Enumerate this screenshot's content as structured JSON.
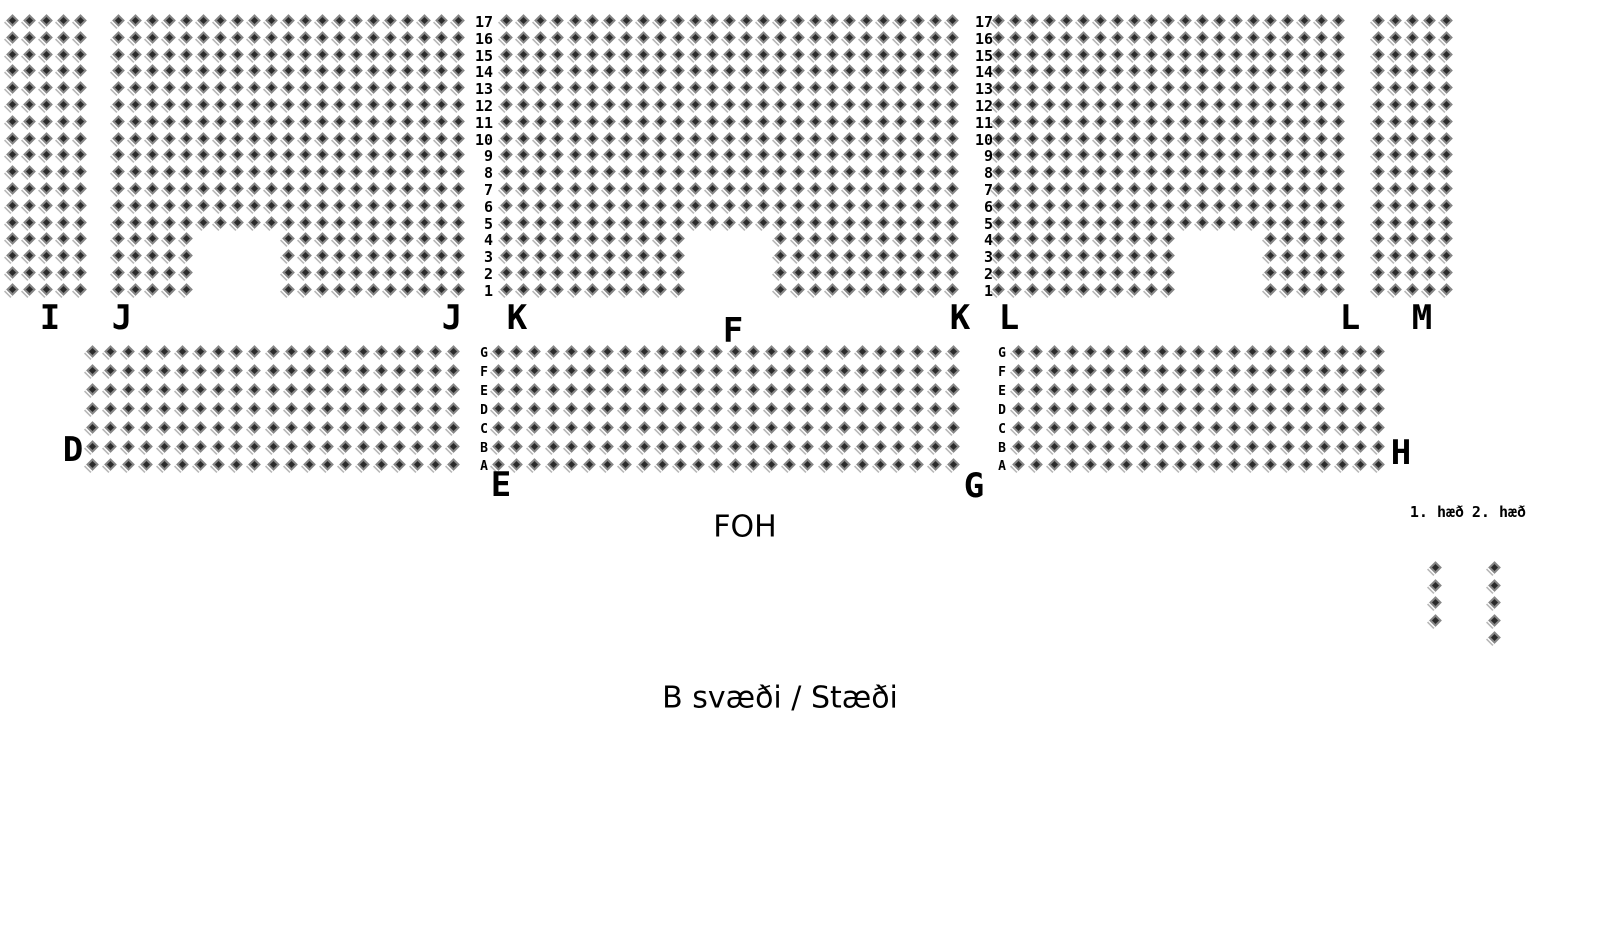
{
  "canvas": {
    "width": 1610,
    "height": 950,
    "background": "#ffffff"
  },
  "labels": {
    "foh": "FOH",
    "area_title": "B svæði / Stæði",
    "legend_floor1": "1. hæð",
    "legend_floor2": "2. hæð"
  },
  "seat_style": {
    "body_color": "#868686",
    "shadow_color": "#b6b6b6",
    "highlight_color": "#ffffff",
    "center_color": "#2a2a2a"
  },
  "seatmap": {
    "row_numbers": [
      "17",
      "16",
      "15",
      "14",
      "13",
      "12",
      "11",
      "10",
      "9",
      "8",
      "7",
      "6",
      "5",
      "4",
      "3",
      "2",
      "1"
    ],
    "row_letters": [
      "G",
      "F",
      "E",
      "D",
      "C",
      "B",
      "A"
    ],
    "sections": [
      {
        "id": "I",
        "x": 6,
        "y": 14,
        "cols": 5,
        "rows": 17,
        "pitch_x": 17.0,
        "pitch_y": 16.8
      },
      {
        "id": "J",
        "x": 112,
        "y": 14,
        "cols": 21,
        "rows": 17,
        "pitch_x": 17.0,
        "pitch_y": 16.8,
        "notch": {
          "col_start": 6,
          "col_end": 10,
          "bottom_rows": 4
        }
      },
      {
        "id": "K",
        "x": 500,
        "y": 14,
        "cols": 27,
        "rows": 17,
        "pitch_x": 17.15,
        "pitch_y": 16.8,
        "notch": {
          "col_start": 12,
          "col_end": 16,
          "bottom_rows": 4
        }
      },
      {
        "id": "L",
        "x": 992,
        "y": 14,
        "cols": 21,
        "rows": 17,
        "pitch_x": 17.0,
        "pitch_y": 16.8,
        "notch": {
          "col_start": 12,
          "col_end": 16,
          "bottom_rows": 4
        }
      },
      {
        "id": "M",
        "x": 1372,
        "y": 14,
        "cols": 5,
        "rows": 17,
        "pitch_x": 17.0,
        "pitch_y": 16.8
      },
      {
        "id": "D",
        "x": 86,
        "y": 345,
        "cols": 21,
        "rows": 7,
        "pitch_x": 18.05,
        "pitch_y": 18.9
      },
      {
        "id": "E",
        "x": 492,
        "y": 345,
        "cols": 26,
        "rows": 7,
        "pitch_x": 18.2,
        "pitch_y": 18.9
      },
      {
        "id": "G",
        "x": 1012,
        "y": 345,
        "cols": 21,
        "rows": 7,
        "pitch_x": 18.0,
        "pitch_y": 18.9
      },
      {
        "id": "floor1-legend",
        "x": 1429,
        "y": 561,
        "cols": 1,
        "rows": 4,
        "pitch_x": 17.5,
        "pitch_y": 17.5
      },
      {
        "id": "floor2-legend",
        "x": 1488,
        "y": 561,
        "cols": 1,
        "rows": 5,
        "pitch_x": 17.5,
        "pitch_y": 17.5
      }
    ],
    "number_columns": [
      {
        "x": 461,
        "y": 14,
        "width": 32,
        "row_height": 16.8
      },
      {
        "x": 961,
        "y": 14,
        "width": 32,
        "row_height": 16.8
      }
    ],
    "letter_columns": [
      {
        "x": 476,
        "y": 345,
        "width": 16,
        "row_height": 18.9
      },
      {
        "x": 994,
        "y": 345,
        "width": 16,
        "row_height": 18.9
      }
    ],
    "section_labels": [
      {
        "text": "I",
        "x": 50,
        "y": 318
      },
      {
        "text": "J",
        "x": 122,
        "y": 318
      },
      {
        "text": "J",
        "x": 452,
        "y": 318
      },
      {
        "text": "K",
        "x": 517,
        "y": 318
      },
      {
        "text": "F",
        "x": 733,
        "y": 331
      },
      {
        "text": "K",
        "x": 960,
        "y": 318
      },
      {
        "text": "L",
        "x": 1009,
        "y": 318
      },
      {
        "text": "L",
        "x": 1350,
        "y": 318
      },
      {
        "text": "M",
        "x": 1422,
        "y": 318
      },
      {
        "text": "D",
        "x": 73,
        "y": 450
      },
      {
        "text": "E",
        "x": 501,
        "y": 485
      },
      {
        "text": "G",
        "x": 974,
        "y": 486
      },
      {
        "text": "H",
        "x": 1401,
        "y": 453
      }
    ]
  }
}
